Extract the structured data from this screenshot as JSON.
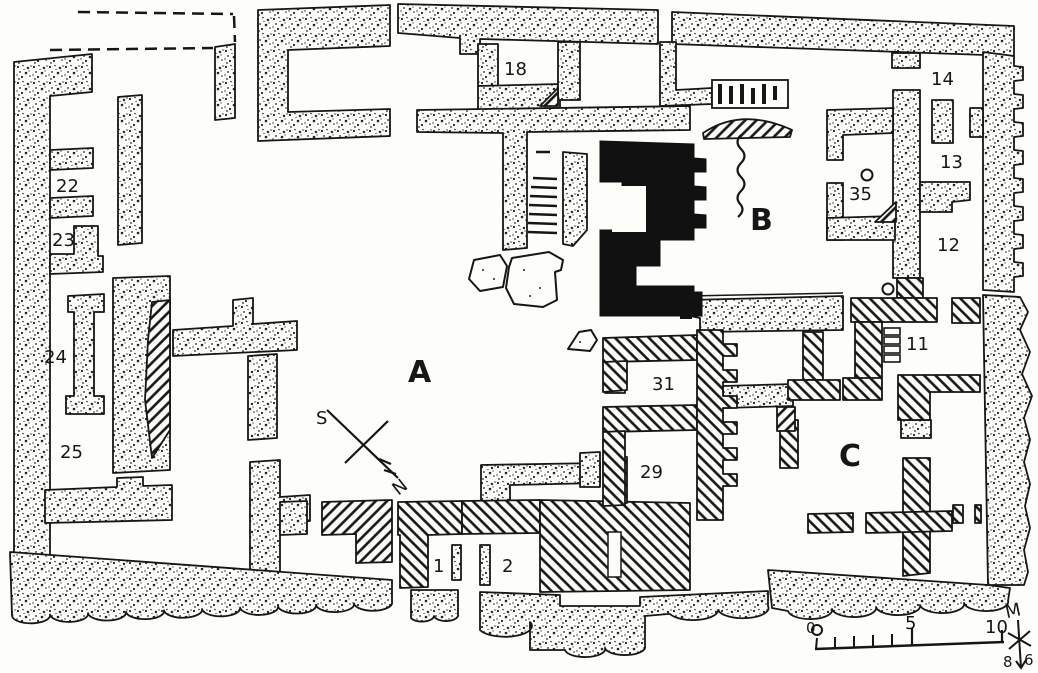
{
  "title": "Excavation ground plan with numbered rooms and courtyards",
  "areas": {
    "a": "A",
    "b": "B",
    "c": "C"
  },
  "rooms": {
    "r1": "1",
    "r2": "2",
    "r11": "11",
    "r12": "12",
    "r13": "13",
    "r14": "14",
    "r18": "18",
    "r22": "22",
    "r23": "23",
    "r24": "24",
    "r25": "25",
    "r29": "29",
    "r31": "31",
    "r35": "35"
  },
  "compass": {
    "south": "S",
    "north": "N"
  },
  "scale_bar": {
    "zero": "0",
    "five": "5",
    "ten": "10",
    "unit": "M",
    "mark_left": "8",
    "mark_right": "6"
  },
  "legend_semantics": {
    "stippled_wall": "stone wall (dotted fill)",
    "hatched_wall": "diagonally hatched wall",
    "black_structure": "solid black monument",
    "dashed_line": "reconstructed wall line",
    "wavy_line": "broken edge near courtyard B"
  },
  "colors": {
    "ink": "#161616",
    "paper": "#fdfdfa"
  }
}
